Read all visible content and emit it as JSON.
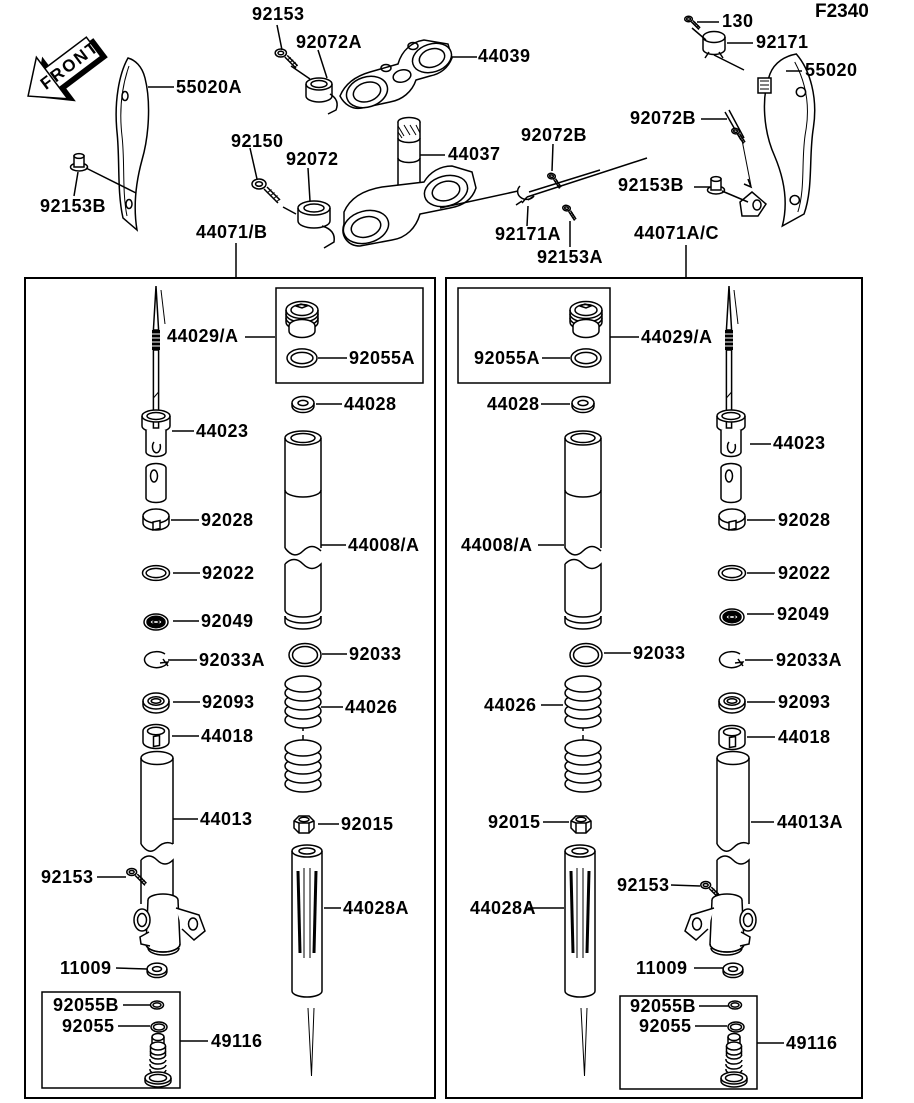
{
  "page": {
    "diagram_code": "F2340",
    "front_arrow_label": "FRONT",
    "ink_color": "#000000",
    "paper_color": "#ffffff"
  },
  "top": {
    "bolt_92153": "92153",
    "holder_92072A": "92072A",
    "upper_clamp_44039": "44039",
    "guard_left_55020A": "55020A",
    "bolt_92150": "92150",
    "holder_92072": "92072",
    "stem_44037": "44037",
    "nut_92153B_left": "92153B",
    "assy_left_44071B": "44071/B",
    "rod_92072B_mid": "92072B",
    "screw_130": "130",
    "clamp_92171": "92171",
    "guard_right_55020": "55020",
    "rod_92072B_right": "92072B",
    "nut_92153B_right": "92153B",
    "clamp_92171A": "92171A",
    "screw_92153A": "92153A",
    "assy_right_44071AC": "44071A/C"
  },
  "left_fork": {
    "piston_rod_44029A": "44029/A",
    "oring_92055A": "92055A",
    "washer_44028": "44028",
    "cylinder_44023": "44023",
    "ring_92028": "92028",
    "outer_tube_44008A": "44008/A",
    "oring_92022": "92022",
    "oil_seal_92049": "92049",
    "snap_ring_92033A": "92033A",
    "oring_92033": "92033",
    "dust_seal_92093": "92093",
    "bushing_44018": "44018",
    "inner_tube_44013": "44013",
    "spring_44026": "44026",
    "nut_92015": "92015",
    "bolt_92153": "92153",
    "washer_11009": "11009",
    "oring_92055B": "92055B",
    "oring_92055": "92055",
    "valve_49116": "49116",
    "damper_rod_44028A": "44028A"
  },
  "right_fork": {
    "piston_rod_44029A": "44029/A",
    "oring_92055A": "92055A",
    "washer_44028": "44028",
    "cylinder_44023": "44023",
    "ring_92028": "92028",
    "outer_tube_44008A": "44008/A",
    "oring_92022": "92022",
    "oil_seal_92049": "92049",
    "snap_ring_92033A": "92033A",
    "oring_92033": "92033",
    "dust_seal_92093": "92093",
    "bushing_44018": "44018",
    "inner_tube_44013A": "44013A",
    "spring_44026": "44026",
    "nut_92015": "92015",
    "bolt_92153": "92153",
    "washer_11009": "11009",
    "oring_92055B": "92055B",
    "oring_92055": "92055",
    "valve_49116": "49116",
    "damper_rod_44028A": "44028A"
  }
}
